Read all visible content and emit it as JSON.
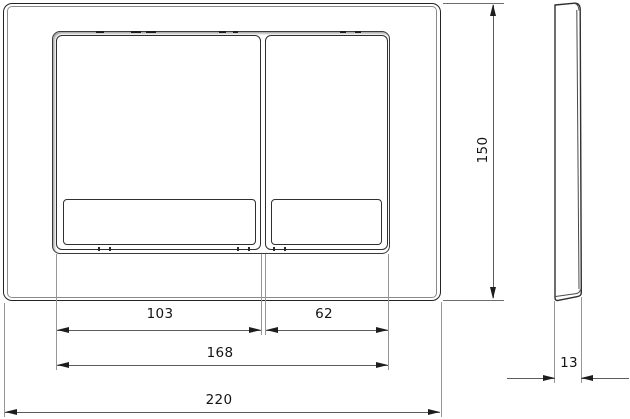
{
  "drawing": {
    "kind": "dual-flush-plate-dimension-drawing",
    "dimensions": {
      "plate_height": "150",
      "large_button_width": "103",
      "small_button_width": "62",
      "buttons_overall_width": "168",
      "plate_width": "220",
      "plate_thickness": "13"
    },
    "colors": {
      "background": "#ffffff",
      "outline": "#2f2f2f",
      "dimension_line": "#5c5c5c",
      "extension_line": "#979797",
      "text": "#141414"
    }
  }
}
